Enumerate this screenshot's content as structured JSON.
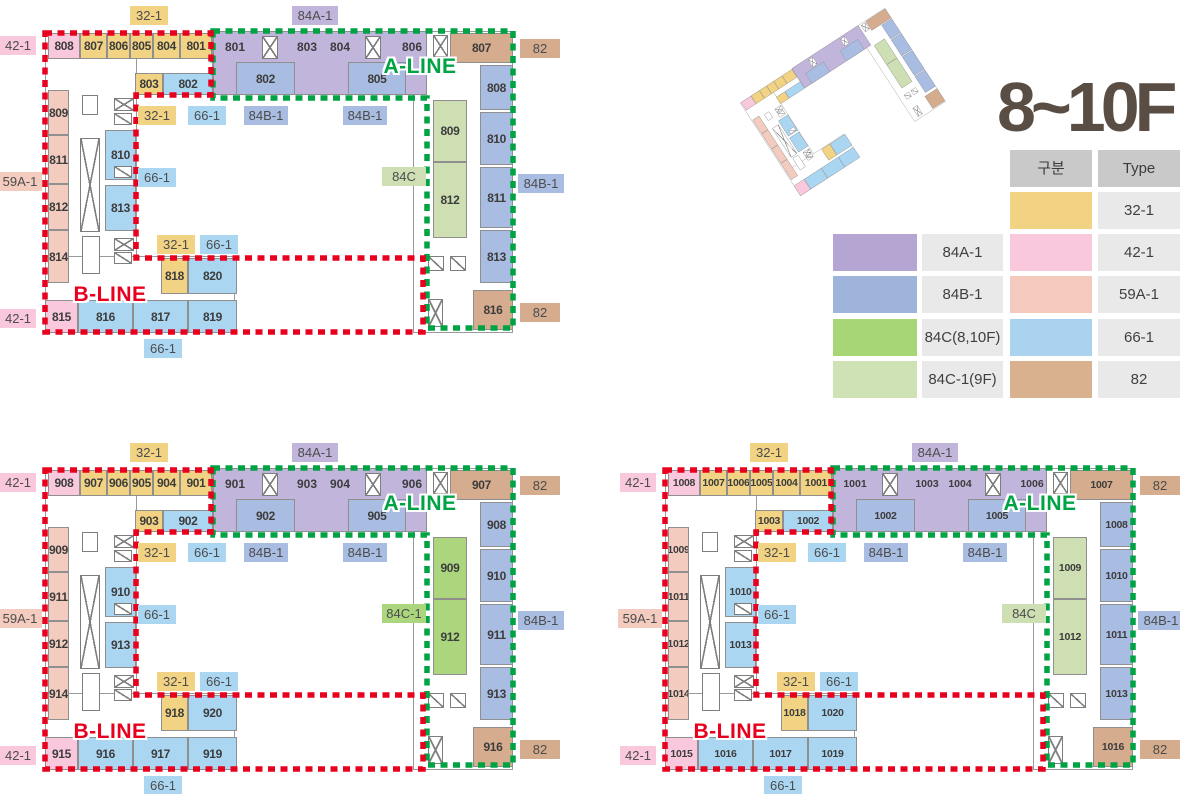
{
  "title": "8~10F",
  "lines": {
    "a_label": "A-LINE",
    "b_label": "B-LINE"
  },
  "colors": {
    "red_line": "#e8001f",
    "green_line": "#00a344",
    "wall": "#8f8f8f",
    "number_text": "#3c3c3c",
    "badge_text": "#4c4c4c",
    "title_text": "#5a4e44",
    "types": {
      "32-1": "#f2d384",
      "42-1": "#f9c8dd",
      "84A-1": "#c2b5db",
      "84B-1": "#a9bce1",
      "59A-1": "#f3cbbf",
      "66-1": "#abd6f2",
      "82": "#d6ac8e",
      "palegreen": "#cddfb3",
      "green": "#abd67e"
    }
  },
  "legend": {
    "headers": [
      "구분",
      "Type"
    ],
    "rows": [
      {
        "right_color": "#f2d384",
        "right_label": "32-1"
      },
      {
        "left_color": "#b4a5d3",
        "left_label": "84A-1",
        "right_color": "#f9c8dd",
        "right_label": "42-1"
      },
      {
        "left_color": "#9fb4db",
        "left_label": "84B-1",
        "right_color": "#f4cabe",
        "right_label": "59A-1"
      },
      {
        "left_color": "#a7d677",
        "left_label": "84C(8,10F)",
        "right_color": "#a9d3ef",
        "right_label": "66-1"
      },
      {
        "left_color": "#cfe2b5",
        "left_label": "84C-1(9F)",
        "right_color": "#d9b18f",
        "right_label": "82"
      }
    ]
  },
  "plans": [
    {
      "key": "8f",
      "origin": {
        "x": 30,
        "y": 6
      },
      "prefix": "8",
      "green_label": "84C",
      "green_color": "palegreen",
      "num_size": 12
    },
    {
      "key": "9f",
      "origin": {
        "x": 30,
        "y": 443
      },
      "prefix": "9",
      "green_label": "84C-1",
      "green_color": "green",
      "num_size": 12
    },
    {
      "key": "10f",
      "origin": {
        "x": 650,
        "y": 443
      },
      "prefix": "10",
      "green_label": "84C",
      "green_color": "palegreen",
      "num_size": 10.5
    }
  ],
  "plan_template": {
    "width": 570,
    "height": 360,
    "base": [
      [
        15,
        27,
        168,
        62
      ],
      [
        183,
        25,
        214,
        64
      ],
      [
        383,
        25,
        100,
        302
      ],
      [
        15,
        27,
        92,
        300
      ],
      [
        15,
        250,
        190,
        77
      ]
    ],
    "zones": [
      {
        "t": "84A-1",
        "x": 183,
        "y": 25,
        "w": 214,
        "h": 64
      }
    ],
    "units": [
      {
        "n": "08",
        "t": "42-1",
        "x": 18,
        "y": 27,
        "w": 32,
        "h": 26
      },
      {
        "n": "07",
        "t": "32-1",
        "x": 50,
        "y": 27,
        "w": 27,
        "h": 26
      },
      {
        "n": "06",
        "t": "32-1",
        "x": 77,
        "y": 27,
        "w": 23,
        "h": 26
      },
      {
        "n": "05",
        "t": "32-1",
        "x": 100,
        "y": 27,
        "w": 23,
        "h": 26
      },
      {
        "n": "04",
        "t": "32-1",
        "x": 123,
        "y": 27,
        "w": 27,
        "h": 26
      },
      {
        "n": "01",
        "t": "32-1",
        "x": 150,
        "y": 27,
        "w": 32,
        "h": 26
      },
      {
        "n": "03",
        "t": "32-1",
        "x": 105,
        "y": 67,
        "w": 28,
        "h": 22
      },
      {
        "n": "02",
        "t": "66-1",
        "x": 133,
        "y": 67,
        "w": 50,
        "h": 22
      },
      {
        "n": "02",
        "t": "84B-1",
        "x": 206,
        "y": 56,
        "w": 59,
        "h": 33
      },
      {
        "n": "05",
        "t": "84B-1",
        "x": 318,
        "y": 56,
        "w": 58,
        "h": 33
      },
      {
        "n": "07",
        "t": "82",
        "x": 420,
        "y": 27,
        "w": 63,
        "h": 30
      },
      {
        "n": "08",
        "t": "84B-1",
        "x": 450,
        "y": 59,
        "w": 33,
        "h": 45
      },
      {
        "n": "10",
        "t": "84B-1",
        "x": 450,
        "y": 106,
        "w": 33,
        "h": 53
      },
      {
        "n": "11",
        "t": "84B-1",
        "x": 450,
        "y": 161,
        "w": 33,
        "h": 61
      },
      {
        "n": "13",
        "t": "84B-1",
        "x": 450,
        "y": 224,
        "w": 33,
        "h": 53
      },
      {
        "n": "16",
        "t": "82",
        "x": 443,
        "y": 284,
        "w": 40,
        "h": 40
      },
      {
        "n": "09",
        "t": "84C",
        "x": 403,
        "y": 94,
        "w": 34,
        "h": 62
      },
      {
        "n": "12",
        "t": "84C",
        "x": 403,
        "y": 156,
        "w": 34,
        "h": 76
      },
      {
        "n": "09",
        "t": "59A-1",
        "x": 18,
        "y": 84,
        "w": 21,
        "h": 45
      },
      {
        "n": "11",
        "t": "59A-1",
        "x": 18,
        "y": 129,
        "w": 21,
        "h": 49
      },
      {
        "n": "12",
        "t": "59A-1",
        "x": 18,
        "y": 178,
        "w": 21,
        "h": 46
      },
      {
        "n": "14",
        "t": "59A-1",
        "x": 18,
        "y": 224,
        "w": 21,
        "h": 53
      },
      {
        "n": "10",
        "t": "66-1",
        "x": 75,
        "y": 124,
        "w": 31,
        "h": 50
      },
      {
        "n": "13",
        "t": "66-1",
        "x": 75,
        "y": 179,
        "w": 31,
        "h": 46
      },
      {
        "n": "18",
        "t": "32-1",
        "x": 131,
        "y": 252,
        "w": 27,
        "h": 36
      },
      {
        "n": "20",
        "t": "66-1",
        "x": 158,
        "y": 252,
        "w": 49,
        "h": 36
      },
      {
        "n": "15",
        "t": "42-1",
        "x": 15,
        "y": 294,
        "w": 33,
        "h": 33
      },
      {
        "n": "16",
        "t": "66-1",
        "x": 48,
        "y": 294,
        "w": 55,
        "h": 33
      },
      {
        "n": "17",
        "t": "66-1",
        "x": 103,
        "y": 294,
        "w": 55,
        "h": 33
      },
      {
        "n": "19",
        "t": "66-1",
        "x": 158,
        "y": 294,
        "w": 49,
        "h": 33
      }
    ],
    "texts": [
      {
        "n": "01",
        "x": 205,
        "y": 41
      },
      {
        "n": "03",
        "x": 277,
        "y": 41
      },
      {
        "n": "04",
        "x": 310,
        "y": 41
      },
      {
        "n": "06",
        "x": 382,
        "y": 41
      }
    ],
    "cores": [
      {
        "k": "x",
        "x": 232,
        "y": 30,
        "w": 16,
        "h": 23
      },
      {
        "k": "x",
        "x": 335,
        "y": 30,
        "w": 16,
        "h": 23
      },
      {
        "k": "x",
        "x": 403,
        "y": 29,
        "w": 15,
        "h": 22
      },
      {
        "k": "x",
        "x": 84,
        "y": 92,
        "w": 20,
        "h": 13
      },
      {
        "k": "h",
        "x": 84,
        "y": 107,
        "w": 18,
        "h": 12
      },
      {
        "k": "r",
        "x": 52,
        "y": 89,
        "w": 16,
        "h": 20
      },
      {
        "k": "x",
        "x": 50,
        "y": 132,
        "w": 20,
        "h": 94
      },
      {
        "k": "h",
        "x": 84,
        "y": 160,
        "w": 18,
        "h": 12
      },
      {
        "k": "r",
        "x": 52,
        "y": 230,
        "w": 18,
        "h": 38
      },
      {
        "k": "x",
        "x": 84,
        "y": 232,
        "w": 20,
        "h": 13
      },
      {
        "k": "h",
        "x": 84,
        "y": 246,
        "w": 18,
        "h": 12
      },
      {
        "k": "h",
        "x": 398,
        "y": 250,
        "w": 16,
        "h": 15
      },
      {
        "k": "h",
        "x": 420,
        "y": 250,
        "w": 16,
        "h": 15
      },
      {
        "k": "x",
        "x": 398,
        "y": 293,
        "w": 15,
        "h": 28
      }
    ],
    "labels": [
      {
        "t": "32-1",
        "x": 100,
        "y": 0,
        "w": 38
      },
      {
        "t": "84A-1",
        "x": 262,
        "y": 0,
        "w": 46
      },
      {
        "t": "42-1",
        "x": -30,
        "y": 30,
        "w": 36
      },
      {
        "t": "59A-1",
        "x": -32,
        "y": 166,
        "w": 44
      },
      {
        "t": "42-1",
        "x": -30,
        "y": 303,
        "w": 36
      },
      {
        "t": "66-1",
        "x": 114,
        "y": 333,
        "w": 38
      },
      {
        "t": "82",
        "x": 490,
        "y": 33,
        "w": 40
      },
      {
        "t": "84B-1",
        "x": 488,
        "y": 168,
        "w": 46
      },
      {
        "t": "82",
        "x": 490,
        "y": 297,
        "w": 40
      },
      {
        "t": "32-1",
        "x": 108,
        "y": 100,
        "w": 38
      },
      {
        "t": "66-1",
        "x": 158,
        "y": 100,
        "w": 38
      },
      {
        "t": "84B-1",
        "x": 214,
        "y": 100,
        "w": 44
      },
      {
        "t": "84B-1",
        "x": 313,
        "y": 100,
        "w": 44
      },
      {
        "t": "66-1",
        "x": 108,
        "y": 162,
        "w": 38
      },
      {
        "t": "84C",
        "x": 352,
        "y": 161,
        "w": 44,
        "green": true
      },
      {
        "t": "32-1",
        "x": 127,
        "y": 229,
        "w": 38
      },
      {
        "t": "66-1",
        "x": 170,
        "y": 229,
        "w": 38
      }
    ],
    "paths": {
      "red": "M15,27 H181 V89 H106 V252 H393 V326 H15 Z",
      "green": "M183,25 H483 V322 H397 V92 H183 Z"
    },
    "line_text": {
      "a": {
        "x": 390,
        "y": 61
      },
      "b": {
        "x": 80,
        "y": 289
      }
    }
  }
}
